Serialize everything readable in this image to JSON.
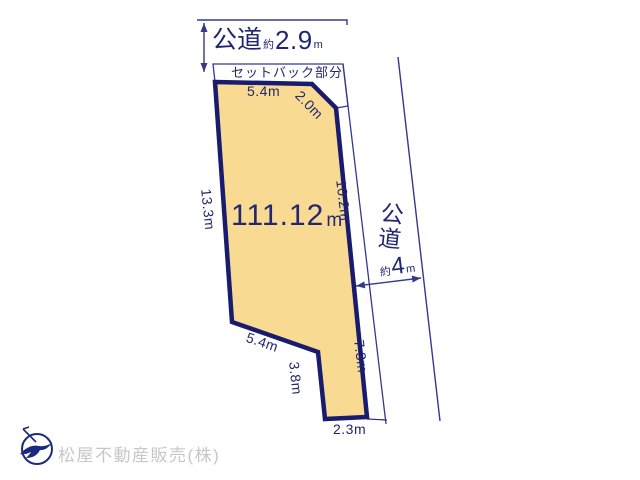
{
  "north_road": {
    "name": "公道",
    "approx": "約",
    "width": "2.9",
    "unit": "m"
  },
  "setback": {
    "label": "セットバック部分"
  },
  "plot": {
    "area_value": "111.12",
    "area_unit_base": "m",
    "area_unit_sup": "2",
    "dims": {
      "top": "5.4m",
      "corner": "2.0m",
      "left": "13.3m",
      "right_upper": "10.2m",
      "right_lower": "7.3m",
      "notch_diag": "5.4m",
      "notch_vert": "3.8m",
      "bottom": "2.3m"
    }
  },
  "east_road": {
    "char_1": "公",
    "char_2": "道",
    "approx": "約",
    "width": "4",
    "unit": "m"
  },
  "footer": {
    "company": "松屋不動産販売(株)"
  },
  "colors": {
    "plot_fill": "#F8DA93",
    "plot_border": "#191B6E",
    "line": "#35398A",
    "text": "#20266F",
    "company_text": "#C7C7C7"
  }
}
